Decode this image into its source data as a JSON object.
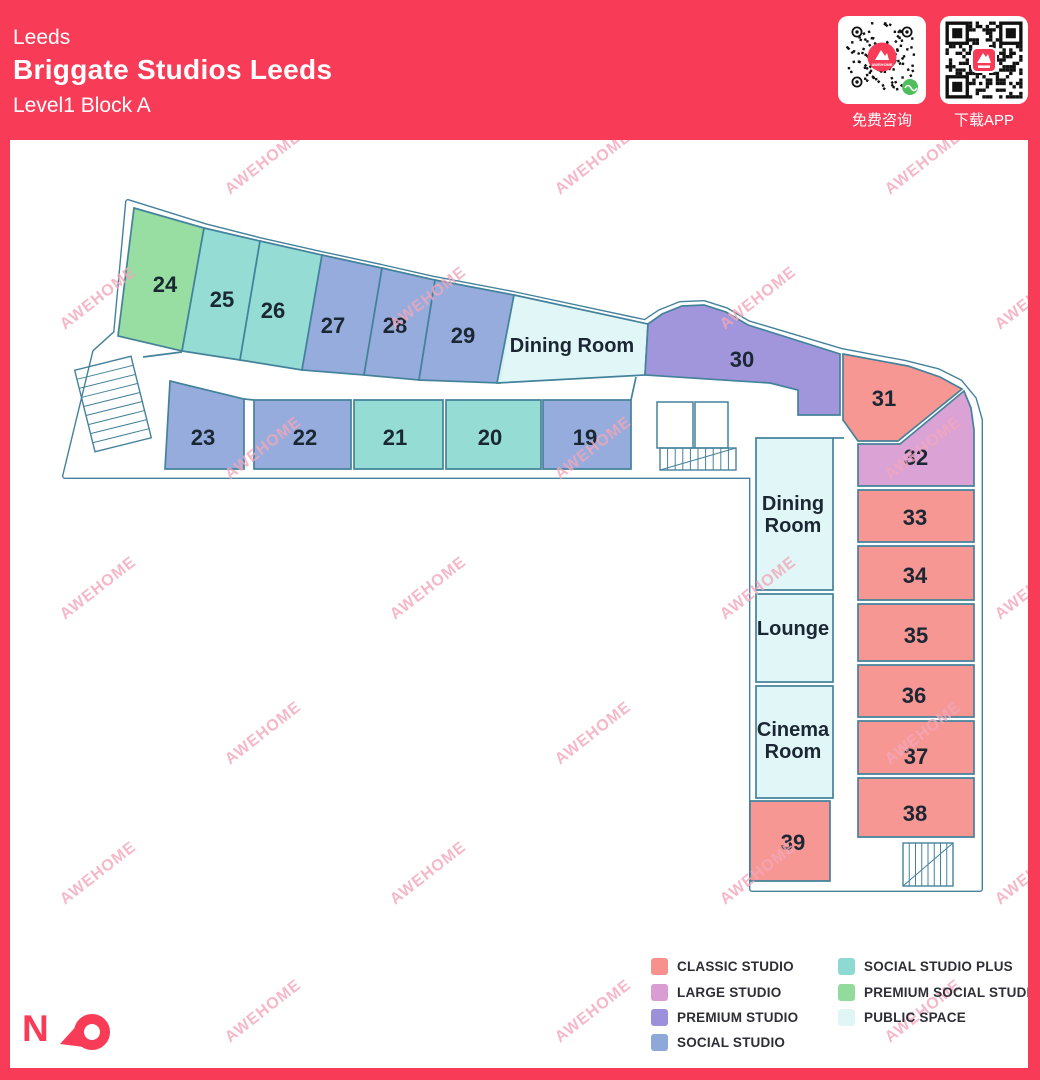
{
  "header": {
    "city": "Leeds",
    "title": "Briggate Studios Leeds",
    "subtitle": "Level1 Block A",
    "qr_consult": {
      "icon": "wechat-mini-qr",
      "label": "免费咨询"
    },
    "qr_app": {
      "icon": "app-download-qr",
      "label": "下载APP"
    }
  },
  "north": {
    "label": "N"
  },
  "watermark": {
    "text": "AWEHOME",
    "color": "#F2A6BA"
  },
  "colors": {
    "frame": "#F83C58",
    "wall": "#44829B",
    "label": "#1B2733",
    "classic": "#F7918E",
    "large": "#D99DD4",
    "premium": "#9C90DA",
    "social": "#8FA8DA",
    "social_plus": "#8EDAD2",
    "premium_social": "#92DB9C",
    "public": "#DFF5F6"
  },
  "legend": {
    "columns": [
      [
        {
          "key": "classic",
          "label": "CLASSIC STUDIO"
        },
        {
          "key": "large",
          "label": "LARGE STUDIO"
        },
        {
          "key": "premium",
          "label": "PREMIUM STUDIO"
        },
        {
          "key": "social",
          "label": "SOCIAL STUDIO"
        }
      ],
      [
        {
          "key": "social_plus",
          "label": "SOCIAL STUDIO PLUS"
        },
        {
          "key": "premium_social",
          "label": "PREMIUM SOCIAL STUDIO"
        },
        {
          "key": "public",
          "label": "PUBLIC SPACE"
        }
      ]
    ]
  },
  "floorplan": {
    "outline": [
      [
        128,
        202
      ],
      [
        205,
        226
      ],
      [
        260,
        240
      ],
      [
        322,
        254
      ],
      [
        382,
        267
      ],
      [
        435,
        279
      ],
      [
        514,
        294
      ],
      [
        645,
        322
      ],
      [
        660,
        312
      ],
      [
        680,
        304
      ],
      [
        704,
        303
      ],
      [
        726,
        310
      ],
      [
        748,
        323
      ],
      [
        842,
        351
      ],
      [
        906,
        363
      ],
      [
        938,
        371
      ],
      [
        960,
        382
      ],
      [
        974,
        399
      ],
      [
        980,
        420
      ],
      [
        980,
        889
      ],
      [
        752,
        889
      ],
      [
        752,
        476
      ],
      [
        65,
        476
      ],
      [
        95,
        352
      ],
      [
        116,
        333
      ]
    ],
    "extra_walls": [
      [
        636,
        377,
        631,
        400
      ],
      [
        143,
        357,
        182,
        352
      ],
      [
        244,
        399,
        254,
        400
      ],
      [
        833,
        438,
        844,
        438
      ]
    ],
    "utility_rooms": [
      [
        657,
        402,
        36,
        46
      ],
      [
        695,
        402,
        33,
        46
      ]
    ],
    "stairs": [
      {
        "x": 84,
        "y": 362,
        "w": 58,
        "h": 84,
        "rot": -14,
        "dir": "h",
        "steps": 9
      },
      {
        "x": 660,
        "y": 448,
        "w": 76,
        "h": 22,
        "rot": 0,
        "dir": "v",
        "steps": 10
      },
      {
        "x": 903,
        "y": 843,
        "w": 50,
        "h": 43,
        "rot": 0,
        "dir": "v",
        "steps": 8
      }
    ],
    "rooms": [
      {
        "id": "24",
        "type": "premium_social",
        "points": [
          [
            134,
            208
          ],
          [
            204,
            228
          ],
          [
            182,
            351
          ],
          [
            118,
            336
          ]
        ],
        "label": {
          "x": 165,
          "y": 292,
          "size": 22,
          "lines": [
            "24"
          ]
        }
      },
      {
        "id": "25",
        "type": "social_plus",
        "points": [
          [
            204,
            228
          ],
          [
            260,
            241
          ],
          [
            240,
            360
          ],
          [
            182,
            351
          ]
        ],
        "label": {
          "x": 222,
          "y": 307,
          "size": 22,
          "lines": [
            "25"
          ]
        }
      },
      {
        "id": "26",
        "type": "social_plus",
        "points": [
          [
            260,
            241
          ],
          [
            322,
            255
          ],
          [
            302,
            370
          ],
          [
            240,
            360
          ]
        ],
        "label": {
          "x": 273,
          "y": 318,
          "size": 22,
          "lines": [
            "26"
          ]
        }
      },
      {
        "id": "27",
        "type": "social",
        "points": [
          [
            322,
            255
          ],
          [
            382,
            268
          ],
          [
            364,
            375
          ],
          [
            302,
            370
          ]
        ],
        "label": {
          "x": 333,
          "y": 333,
          "size": 22,
          "lines": [
            "27"
          ]
        }
      },
      {
        "id": "28",
        "type": "social",
        "points": [
          [
            382,
            268
          ],
          [
            435,
            280
          ],
          [
            419,
            380
          ],
          [
            364,
            375
          ]
        ],
        "label": {
          "x": 395,
          "y": 333,
          "size": 22,
          "lines": [
            "28"
          ]
        }
      },
      {
        "id": "29",
        "type": "social",
        "points": [
          [
            435,
            280
          ],
          [
            514,
            295
          ],
          [
            500,
            383
          ],
          [
            419,
            380
          ]
        ],
        "label": {
          "x": 463,
          "y": 343,
          "size": 22,
          "lines": [
            "29"
          ]
        }
      },
      {
        "id": "dining-top",
        "type": "public",
        "points": [
          [
            514,
            295
          ],
          [
            648,
            324
          ],
          [
            645,
            375
          ],
          [
            497,
            383
          ]
        ],
        "label": {
          "x": 572,
          "y": 352,
          "size": 20,
          "lines": [
            "Dining Room"
          ]
        }
      },
      {
        "id": "30",
        "type": "premium",
        "points": [
          [
            648,
            324
          ],
          [
            662,
            314
          ],
          [
            682,
            306
          ],
          [
            704,
            305
          ],
          [
            726,
            312
          ],
          [
            748,
            325
          ],
          [
            840,
            354
          ],
          [
            840,
            415
          ],
          [
            798,
            415
          ],
          [
            798,
            390
          ],
          [
            770,
            383
          ],
          [
            645,
            375
          ]
        ],
        "label": {
          "x": 742,
          "y": 367,
          "size": 22,
          "lines": [
            "30"
          ]
        }
      },
      {
        "id": "31",
        "type": "classic",
        "points": [
          [
            843,
            354
          ],
          [
            908,
            366
          ],
          [
            940,
            377
          ],
          [
            962,
            389
          ],
          [
            898,
            441
          ],
          [
            858,
            441
          ],
          [
            843,
            420
          ]
        ],
        "label": {
          "x": 884,
          "y": 406,
          "size": 22,
          "lines": [
            "31"
          ]
        }
      },
      {
        "id": "32",
        "type": "large",
        "points": [
          [
            900,
            444
          ],
          [
            964,
            391
          ],
          [
            971,
            408
          ],
          [
            974,
            430
          ],
          [
            974,
            486
          ],
          [
            858,
            486
          ],
          [
            858,
            444
          ]
        ],
        "label": {
          "x": 916,
          "y": 465,
          "size": 22,
          "lines": [
            "32"
          ]
        }
      },
      {
        "id": "33",
        "type": "classic",
        "points": [
          [
            858,
            490
          ],
          [
            974,
            490
          ],
          [
            974,
            542
          ],
          [
            858,
            542
          ]
        ],
        "label": {
          "x": 915,
          "y": 525,
          "size": 22,
          "lines": [
            "33"
          ]
        }
      },
      {
        "id": "34",
        "type": "classic",
        "points": [
          [
            858,
            546
          ],
          [
            974,
            546
          ],
          [
            974,
            600
          ],
          [
            858,
            600
          ]
        ],
        "label": {
          "x": 915,
          "y": 583,
          "size": 22,
          "lines": [
            "34"
          ]
        }
      },
      {
        "id": "35",
        "type": "classic",
        "points": [
          [
            858,
            604
          ],
          [
            974,
            604
          ],
          [
            974,
            661
          ],
          [
            858,
            661
          ]
        ],
        "label": {
          "x": 916,
          "y": 643,
          "size": 22,
          "lines": [
            "35"
          ]
        }
      },
      {
        "id": "36",
        "type": "classic",
        "points": [
          [
            858,
            665
          ],
          [
            974,
            665
          ],
          [
            974,
            717
          ],
          [
            858,
            717
          ]
        ],
        "label": {
          "x": 914,
          "y": 703,
          "size": 22,
          "lines": [
            "36"
          ]
        }
      },
      {
        "id": "37",
        "type": "classic",
        "points": [
          [
            858,
            721
          ],
          [
            974,
            721
          ],
          [
            974,
            774
          ],
          [
            858,
            774
          ]
        ],
        "label": {
          "x": 916,
          "y": 764,
          "size": 22,
          "lines": [
            "37"
          ]
        }
      },
      {
        "id": "38",
        "type": "classic",
        "points": [
          [
            858,
            778
          ],
          [
            974,
            778
          ],
          [
            974,
            837
          ],
          [
            858,
            837
          ]
        ],
        "label": {
          "x": 915,
          "y": 821,
          "size": 22,
          "lines": [
            "38"
          ]
        }
      },
      {
        "id": "dining-right",
        "type": "public",
        "points": [
          [
            756,
            438
          ],
          [
            833,
            438
          ],
          [
            833,
            590
          ],
          [
            756,
            590
          ]
        ],
        "label": {
          "x": 793,
          "y": 510,
          "size": 20,
          "lines": [
            "Dining",
            "Room"
          ]
        }
      },
      {
        "id": "lounge",
        "type": "public",
        "points": [
          [
            756,
            594
          ],
          [
            833,
            594
          ],
          [
            833,
            682
          ],
          [
            756,
            682
          ]
        ],
        "label": {
          "x": 793,
          "y": 635,
          "size": 20,
          "lines": [
            "Lounge"
          ]
        }
      },
      {
        "id": "cinema",
        "type": "public",
        "points": [
          [
            756,
            686
          ],
          [
            833,
            686
          ],
          [
            833,
            798
          ],
          [
            756,
            798
          ]
        ],
        "label": {
          "x": 793,
          "y": 736,
          "size": 20,
          "lines": [
            "Cinema",
            "Room"
          ]
        }
      },
      {
        "id": "39",
        "type": "classic",
        "points": [
          [
            750,
            801
          ],
          [
            830,
            801
          ],
          [
            830,
            881
          ],
          [
            750,
            881
          ]
        ],
        "label": {
          "x": 793,
          "y": 850,
          "size": 22,
          "lines": [
            "39"
          ]
        }
      },
      {
        "id": "23",
        "type": "social",
        "points": [
          [
            170,
            381
          ],
          [
            244,
            399
          ],
          [
            244,
            469
          ],
          [
            165,
            469
          ]
        ],
        "label": {
          "x": 203,
          "y": 445,
          "size": 22,
          "lines": [
            "23"
          ]
        }
      },
      {
        "id": "22",
        "type": "social",
        "points": [
          [
            254,
            400
          ],
          [
            351,
            400
          ],
          [
            351,
            469
          ],
          [
            254,
            469
          ]
        ],
        "label": {
          "x": 305,
          "y": 445,
          "size": 22,
          "lines": [
            "22"
          ]
        }
      },
      {
        "id": "21",
        "type": "social_plus",
        "points": [
          [
            354,
            400
          ],
          [
            443,
            400
          ],
          [
            443,
            469
          ],
          [
            354,
            469
          ]
        ],
        "label": {
          "x": 395,
          "y": 445,
          "size": 22,
          "lines": [
            "21"
          ]
        }
      },
      {
        "id": "20",
        "type": "social_plus",
        "points": [
          [
            446,
            400
          ],
          [
            541,
            400
          ],
          [
            541,
            469
          ],
          [
            446,
            469
          ]
        ],
        "label": {
          "x": 490,
          "y": 445,
          "size": 22,
          "lines": [
            "20"
          ]
        }
      },
      {
        "id": "19",
        "type": "social",
        "points": [
          [
            543,
            400
          ],
          [
            631,
            400
          ],
          [
            631,
            469
          ],
          [
            543,
            469
          ]
        ],
        "label": {
          "x": 585,
          "y": 445,
          "size": 22,
          "lines": [
            "19"
          ]
        }
      }
    ]
  }
}
